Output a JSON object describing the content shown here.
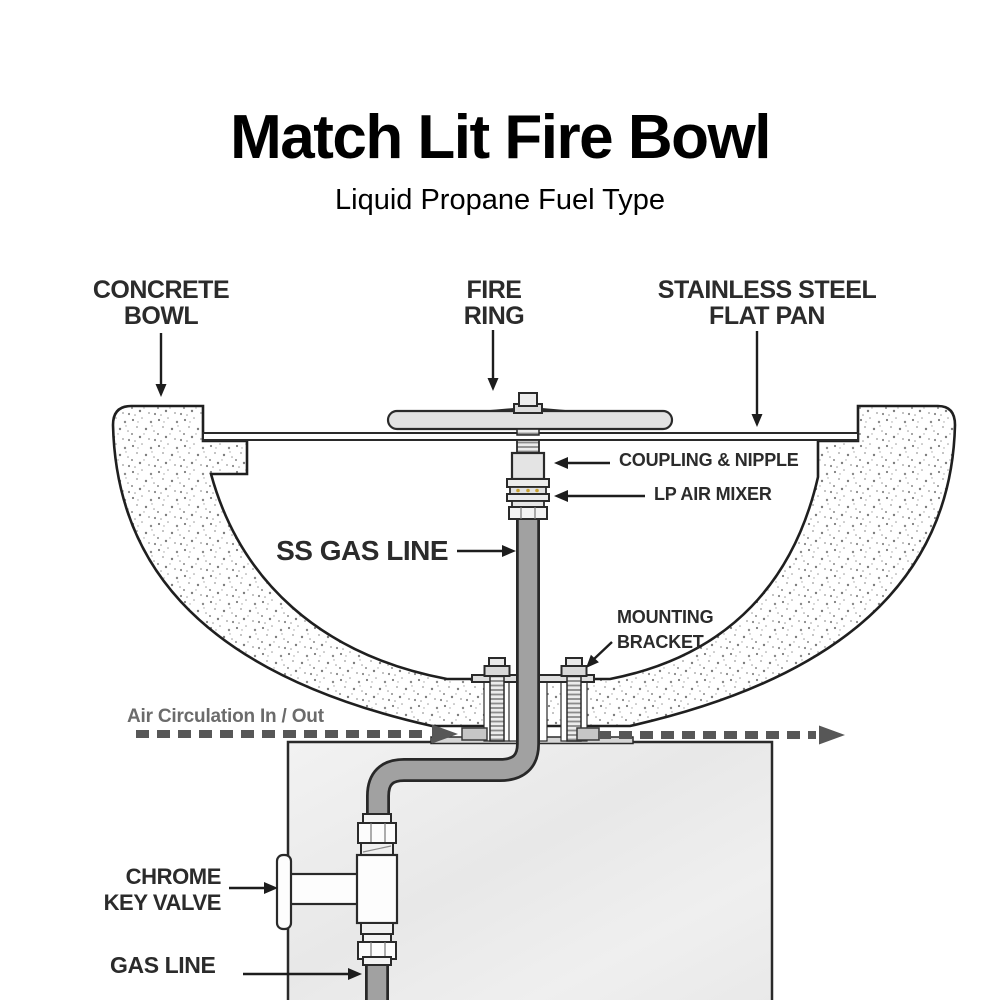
{
  "header": {
    "title": "Match Lit Fire Bowl",
    "subtitle": "Liquid Propane Fuel Type"
  },
  "labels": {
    "concrete_bowl": {
      "line1": "CONCRETE",
      "line2": "BOWL"
    },
    "fire_ring": {
      "line1": "FIRE",
      "line2": "RING"
    },
    "flat_pan": {
      "line1": "STAINLESS STEEL",
      "line2": "FLAT PAN"
    },
    "coupling_nipple": "COUPLING & NIPPLE",
    "lp_air_mixer": "LP AIR MIXER",
    "ss_gas_line": "SS GAS LINE",
    "mounting_bracket": {
      "line1": "MOUNTING",
      "line2": "BRACKET"
    },
    "air_circulation": "Air Circulation In / Out",
    "chrome_key_valve": {
      "line1": "CHROME",
      "line2": "KEY VALVE"
    },
    "gas_line": "GAS LINE"
  },
  "colors": {
    "outline": "#2a2a2a",
    "label_text": "#2b2b2b",
    "air_circulation_text": "#6b6b6b",
    "air_dash": "#575757",
    "metal_light": "#e4e4e4",
    "gas_tube": "#a1a1a1",
    "pedestal": "#ededed",
    "brass_accent": "#c9a12f",
    "background": "#ffffff"
  }
}
